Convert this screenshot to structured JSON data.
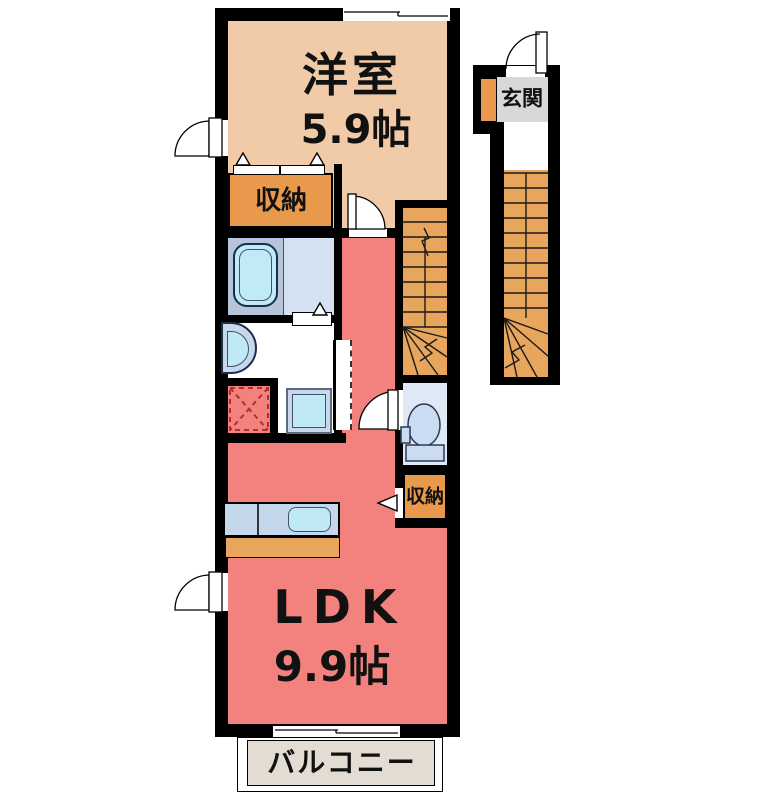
{
  "plan": {
    "type": "apartment-floor-plan",
    "rooms": {
      "western_room": {
        "label": "洋室",
        "size": "5.9帖"
      },
      "ldk": {
        "label": "LDK",
        "size": "9.9帖"
      },
      "closet_upper": {
        "label": "収納"
      },
      "closet_lower": {
        "label": "収納"
      },
      "entrance": {
        "label": "玄関"
      },
      "balcony": {
        "label": "バルコニー"
      }
    },
    "fixtures": [
      "bathtub",
      "washbasin",
      "washing-machine-space",
      "laundry-appliance",
      "kitchen-counter",
      "kitchen-sink",
      "toilet",
      "interior-staircase",
      "exterior-staircase",
      "shoe-cabinet"
    ],
    "colors": {
      "wall": "#000000",
      "background": "#ffffff",
      "western": "#f1cba8",
      "ldk": "#f3827e",
      "closet": "#e9994c",
      "stairs": "#e8a55c",
      "bath_dark": "#b6c5da",
      "bath_light": "#d4e1f0",
      "tub": "#c0ebf6",
      "cyan": "#bfe9f5",
      "frame": "#c7d8ea",
      "counter": "#c5d7eb",
      "toilet_floor": "#dfe9f6",
      "toilet_fixture": "#cadcf2",
      "genkan": "#d8d8d8",
      "balcony": "#e2dcd2",
      "laundry": "#b03030"
    }
  }
}
